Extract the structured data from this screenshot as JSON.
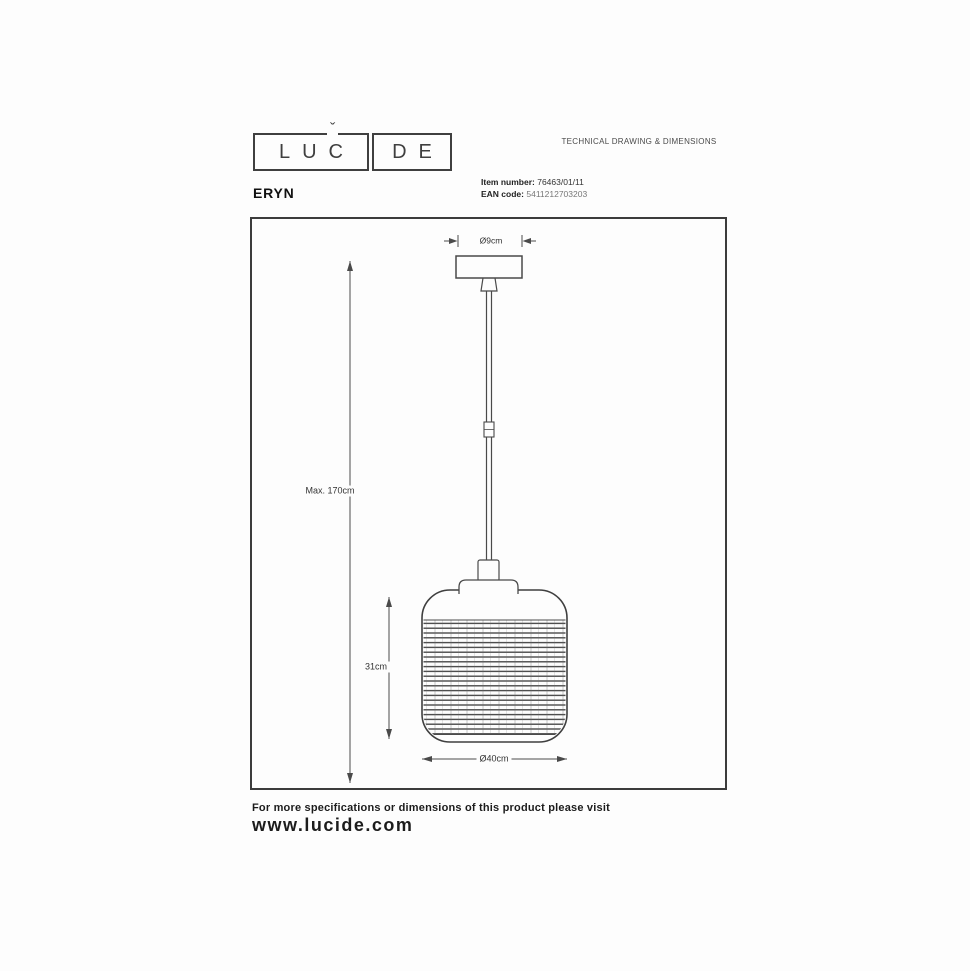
{
  "header": {
    "logo_left": "LUC",
    "logo_right": "DE",
    "logo_accent": "ˇ",
    "doc_title": "TECHNICAL DRAWING & DIMENSIONS",
    "product_name": "ERYN",
    "item_number": {
      "label": "Item number:",
      "value": "76463/01/11"
    },
    "ean": {
      "label": "EAN code:",
      "value": "5411212703203"
    }
  },
  "drawing": {
    "dims": {
      "canopy_diameter": "Ø9cm",
      "total_height": "Max. 170cm",
      "shade_height": "31cm",
      "shade_diameter": "Ø40cm"
    }
  },
  "footer": {
    "note": "For more specifications or dimensions of this product please visit",
    "website": "www.lucide.com"
  },
  "colors": {
    "line": "#4a4a4a",
    "frame": "#3c3c3c",
    "text": "#1f1f1f"
  }
}
